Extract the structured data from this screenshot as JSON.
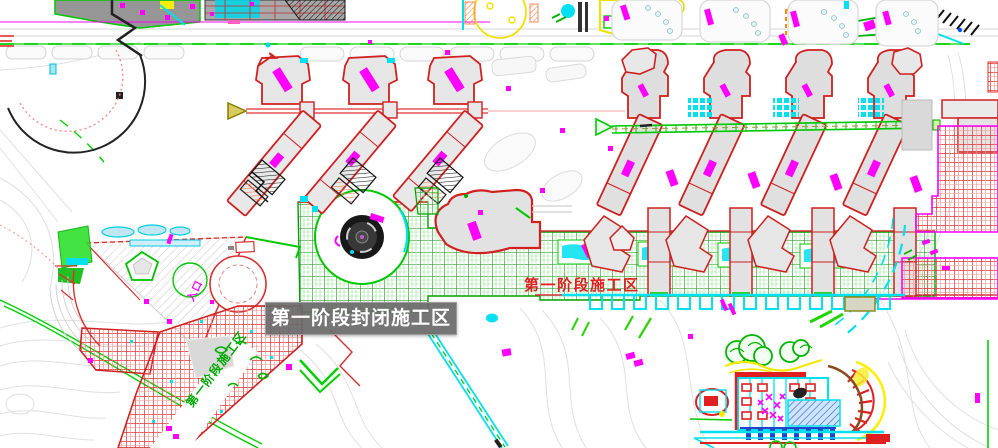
{
  "canvas": {
    "width": 998,
    "height": 448,
    "kind": "construction-site-plan"
  },
  "tooltip": {
    "text": "第一阶段封闭施工区"
  },
  "zone_labels": {
    "band_red": {
      "text": "第一阶段施工区",
      "color": "#e02020"
    },
    "diagonal_green": {
      "text": "第一阶段施工区",
      "color": "#00a800"
    },
    "plaza_magenta": {
      "text": "入口",
      "color": "#ff00ff"
    }
  },
  "palette": {
    "building_outline_red": "#d02020",
    "building_fill_gray": "#e0e0e0",
    "closed_zone_hatch_red": "#e03030",
    "construction_zone_green": "#2f9e2f",
    "zone_border_magenta": "#ff00ff",
    "water_cyan": "#00e0f0",
    "road_gray": "#d9d9d9",
    "highlight_yellow": "#f5e800",
    "tooltip_bg": "#6a6a6a"
  }
}
